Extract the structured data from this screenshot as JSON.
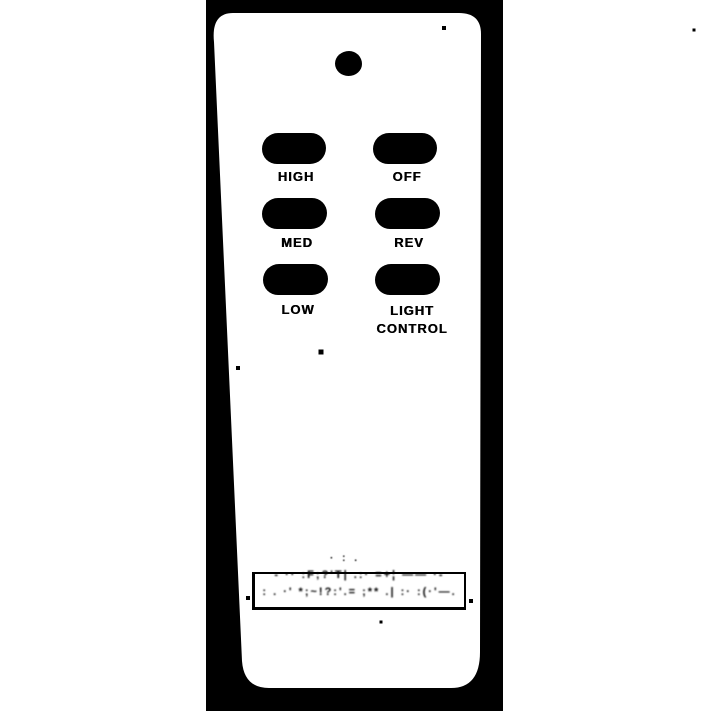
{
  "scene": {
    "type": "binarized black-and-white scanned photo",
    "subject": "handheld ceiling-fan remote control",
    "page_background_color": "#ffffff",
    "photo_background_color": "#000000",
    "remote_body_color": "#ffffff",
    "ink_color": "#000000"
  },
  "remote": {
    "led": {
      "description": "small round indicator dot at top of remote"
    },
    "buttons": [
      {
        "id": "high",
        "label": "HIGH"
      },
      {
        "id": "off",
        "label": "OFF"
      },
      {
        "id": "med",
        "label": "MED"
      },
      {
        "id": "rev",
        "label": "REV"
      },
      {
        "id": "low",
        "label": "LOW"
      },
      {
        "id": "light-control",
        "label": "LIGHT",
        "label2": "CONTROL"
      }
    ],
    "plate": {
      "text_legible": false,
      "noise_above": "· : .",
      "noise_line_1": "- ·· :F;?'T| .:· =+¦ —— ·-",
      "noise_line_2": ": . ·' *;~!?:'.= ;** .| :· :(·'—."
    }
  }
}
